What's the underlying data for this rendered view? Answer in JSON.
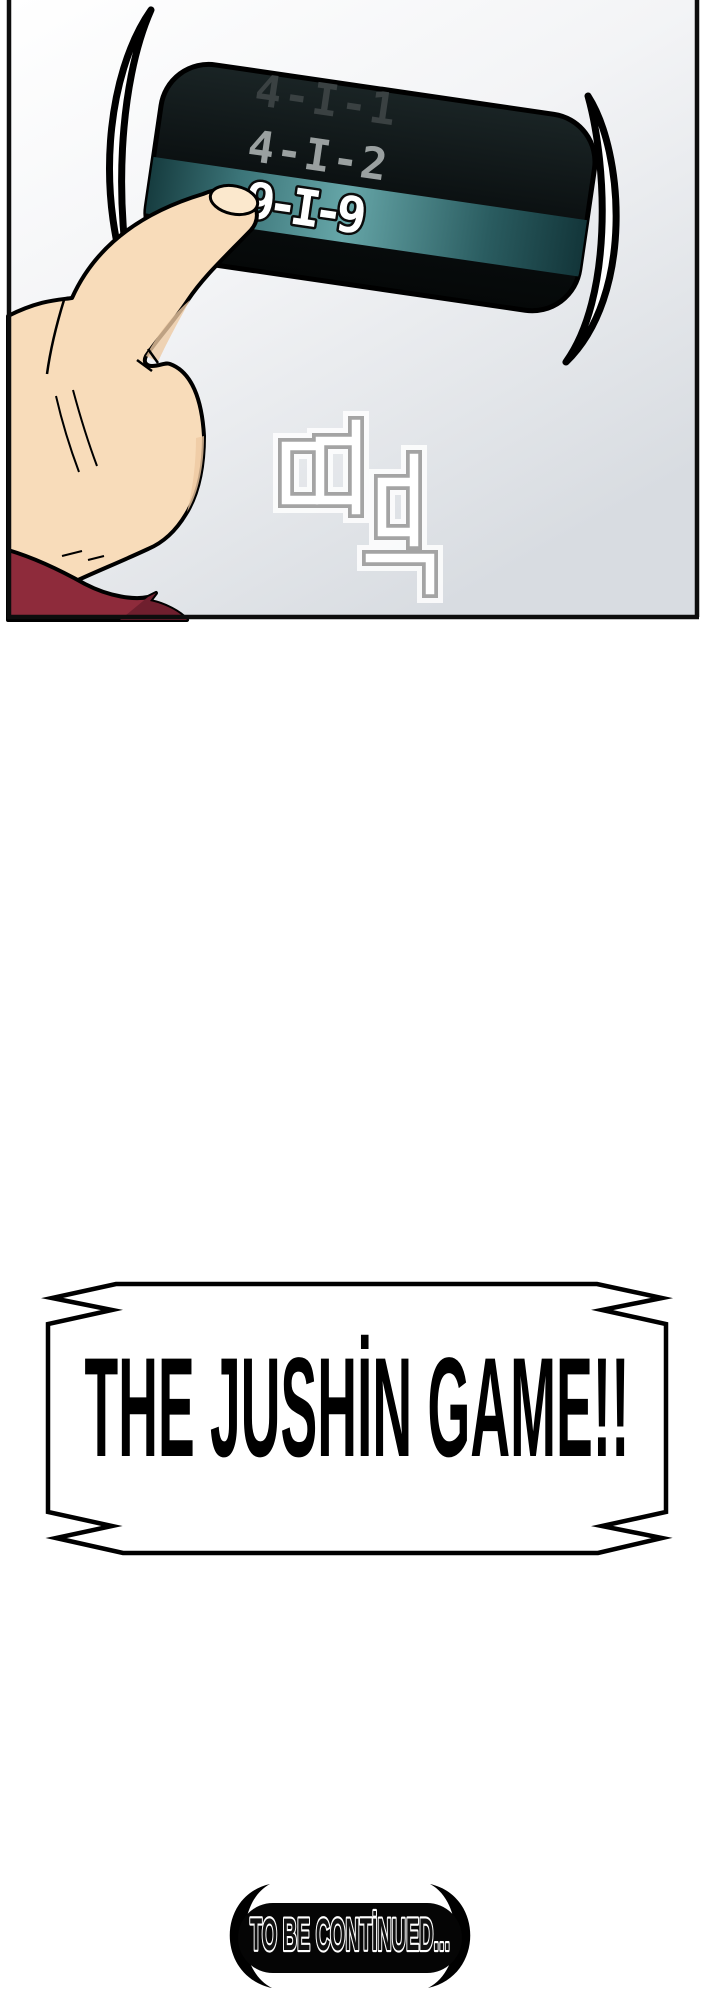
{
  "page": {
    "background_color": "#ffffff"
  },
  "panel": {
    "border_color": "#0d0d0d",
    "background_top": "#ffffff",
    "background_bottom": "#d8dce1",
    "device": {
      "body_color_top": "#1a2425",
      "body_color_bottom": "#050808",
      "rows": [
        {
          "label": "4-I-1",
          "color": "#3a4142",
          "state": "dim"
        },
        {
          "label": "4-I-2",
          "color": "#9aa0a0",
          "state": "normal"
        },
        {
          "label": "9-I-9",
          "color": "#ffffff",
          "state": "selected"
        }
      ],
      "band": {
        "stop_left": "#0f3134",
        "stop_mid_left": "#3b7478",
        "stop_mid": "#66a6a8",
        "stop_mid_right": "#2a5c60",
        "stop_right": "#0d2c30"
      }
    },
    "shine_mark_color": "#ffffff",
    "sound_effect": {
      "text": "띠딕",
      "outline_color": "#a4a4a4",
      "fill_color": "#ffffff"
    },
    "hand": {
      "skin_color": "#f8dcba",
      "shade_color": "#eec9a2",
      "nail_color": "#fbe8cd",
      "sleeve_color": "#8e2b3b",
      "sleeve_shade_color": "#6f1f2e"
    }
  },
  "title_banner": {
    "text": "THE JUSHİN GAME!!",
    "text_color": "#000000",
    "fill_color": "#ffffff",
    "border_color": "#000000"
  },
  "continued_badge": {
    "text": "TO BE CONTİNUED...",
    "text_fill": "#111111",
    "text_outline": "#ffffff",
    "pill_color": "#050505"
  }
}
